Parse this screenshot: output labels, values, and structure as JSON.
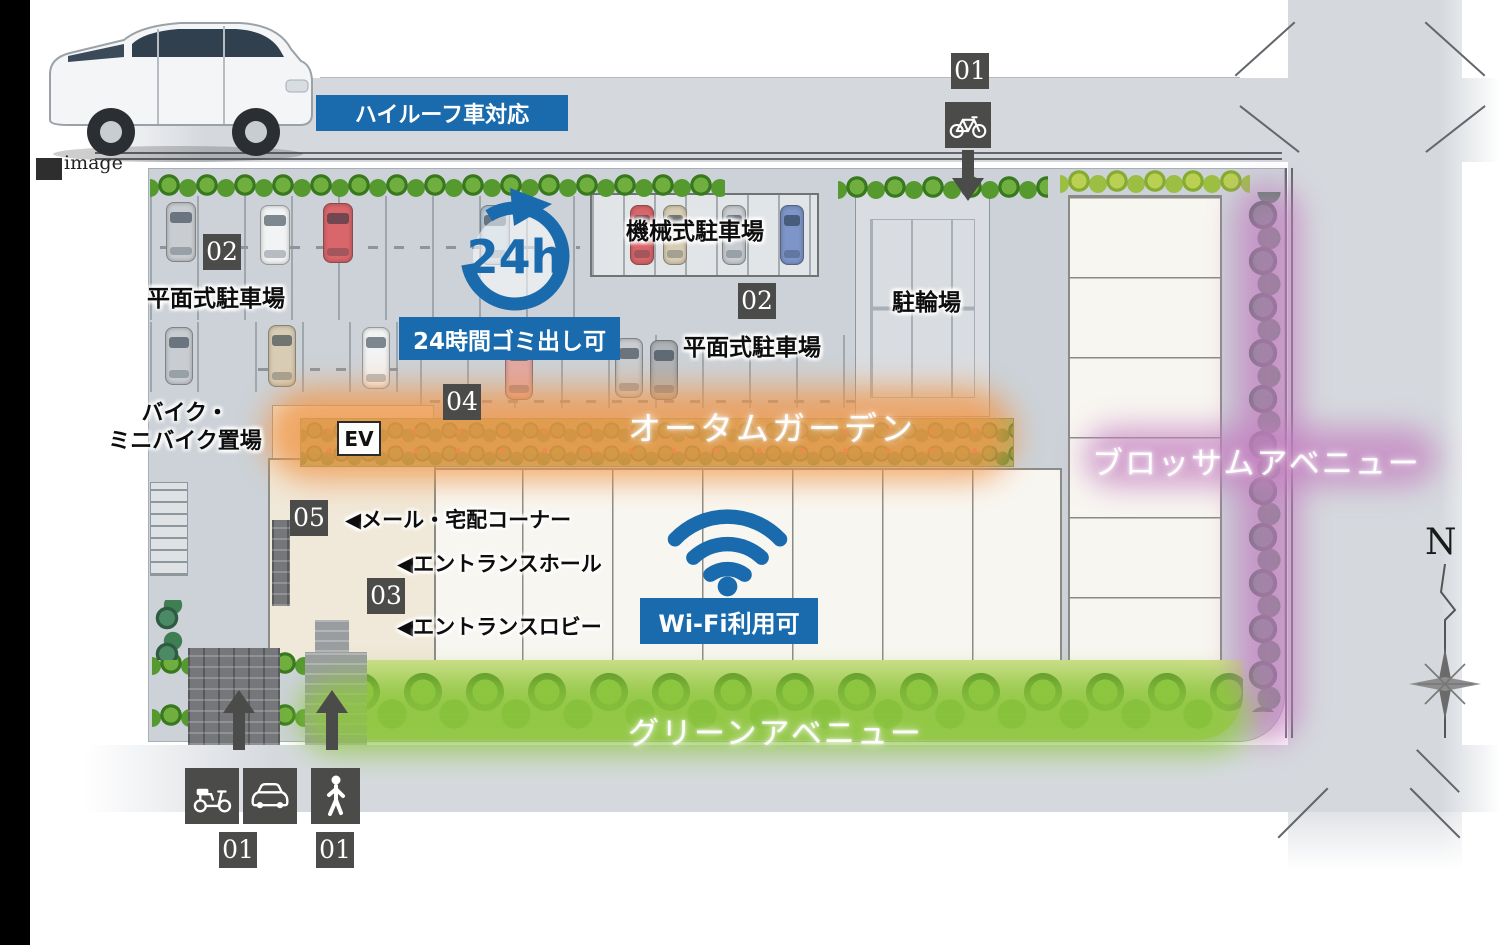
{
  "colors": {
    "accent_blue": "#1a6bad",
    "badge_gray": "#4b4b49",
    "autumn_orange": "#f0974a",
    "blossom_purple": "#c481c0",
    "green_avenue_green": "#8dc63f",
    "road_gray": "#d5d9de"
  },
  "photo": {
    "caption": "image"
  },
  "banners": {
    "high_roof": "ハイルーフ車対応",
    "garbage": "24時間ゴミ出し可",
    "garbage_icon_text": "24h",
    "wifi": "Wi-Fi利用可"
  },
  "badges": {
    "bicycle_entrance": "01",
    "vehicle_entrance": "01",
    "pedestrian_entrance": "01",
    "flat_parking_left": "02",
    "flat_parking_right": "02",
    "entrance": "03",
    "garbage": "04",
    "mail": "05"
  },
  "areas": {
    "mechanical_parking": "機械式駐車場",
    "flat_parking_left": "平面式駐車場",
    "flat_parking_right": "平面式駐車場",
    "bicycle_parking": "駐輪場",
    "bike_storage_line1": "バイク・",
    "bike_storage_line2": "ミニバイク置場",
    "elevator": "EV"
  },
  "facilities": {
    "marker": "◀",
    "mail_corner": "メール・宅配コーナー",
    "entrance_hall": "エントランスホール",
    "entrance_lobby": "エントランスロビー"
  },
  "avenues": {
    "autumn": "オータムガーデン",
    "blossom": "ブロッサムアベニュー",
    "green": "グリーンアベニュー"
  },
  "compass": {
    "north": "N"
  }
}
